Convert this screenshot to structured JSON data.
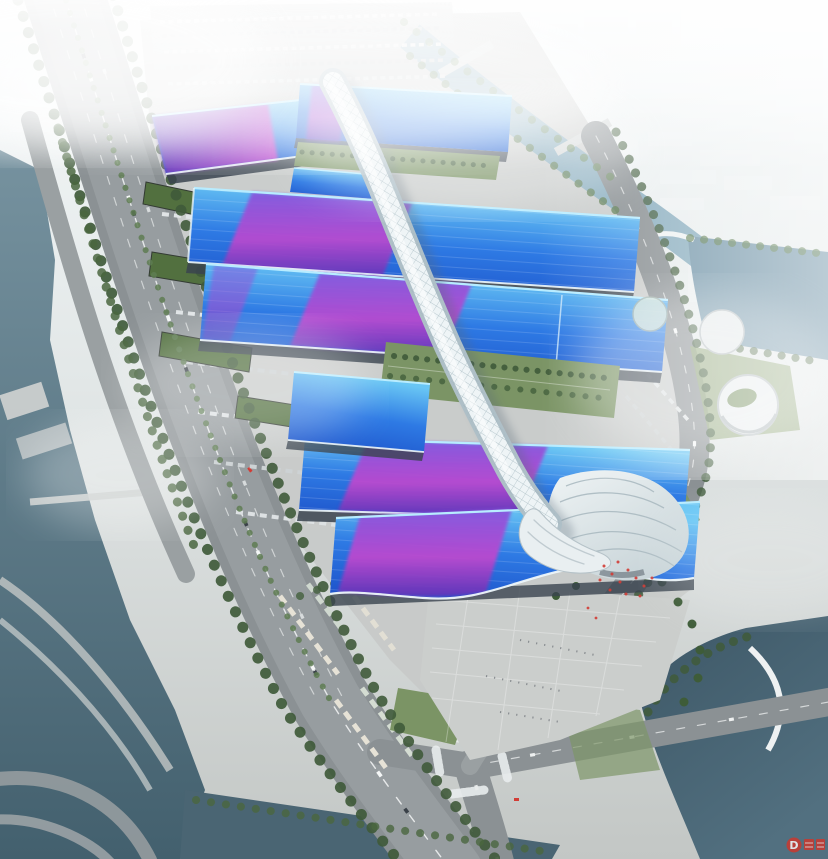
{
  "scene": {
    "title": "Aerial rendering of a riverside exhibition and convention center complex",
    "description": "Bird's-eye architectural rendering: rows of parallel exhibition halls with blue roofs swept by magenta-purple ribbon graphics, a white quilted serpentine concourse spine running down the middle, a white shell-shaped entrance hall and arrival plaza, surrounded by boulevards, truck and bus parking, canals and rivers with bridges, tree rows, and a hazy white city skyline fading into fog.",
    "watermark": {
      "glyph": "D"
    },
    "palette": {
      "sky_top": "#f4f8f9",
      "city_white": "#f2f5f6",
      "ground_concrete": "#c6c9c8",
      "parking_light": "#ced1d1",
      "plaza_light": "#cbcecc",
      "road_asphalt": "#8b9194",
      "road_light": "#a3a8aa",
      "lane_marking": "#eef1f1",
      "water_river": "#76929f",
      "water_deep": "#43606e",
      "water_canal": "#8cafc0",
      "tree_dark": "#3f5a3a",
      "tree_light": "#5e7d52",
      "grass": "#7b9465",
      "shed_roof_green": "#52703f",
      "roof_blue_deep": "#1c50c8",
      "roof_blue": "#2e7ae4",
      "roof_blue_light": "#69c6f4",
      "roof_rim_cyan": "#b8ecff",
      "ribbon_magenta": "#bc49cf",
      "ribbon_purple": "#8655dd",
      "ribbon_purple_deep": "#5f35b8",
      "spine_white": "#eef4f6",
      "spine_shade": "#aebfc7",
      "shell_white": "#eff4f5",
      "wall_dark": "#3a434f",
      "accent_red": "#d23c35",
      "watermark_red": "#d0362b"
    },
    "elements": [
      "hazy-city-skyline",
      "left-river",
      "top-canal",
      "right-river",
      "bottom-right-water",
      "bottom-canal",
      "boulevard",
      "riverside-road",
      "ring-road",
      "intersection",
      "exhibition-halls",
      "ribbon-roof-graphics",
      "rooftop-garden",
      "central-concourse-spine",
      "entrance-shell-hall",
      "arrival-plaza",
      "car-parking",
      "truck-parking",
      "bus-parking",
      "warehouses",
      "round-buildings",
      "bridges",
      "tree-rows",
      "fog",
      "watermark-logo"
    ]
  }
}
